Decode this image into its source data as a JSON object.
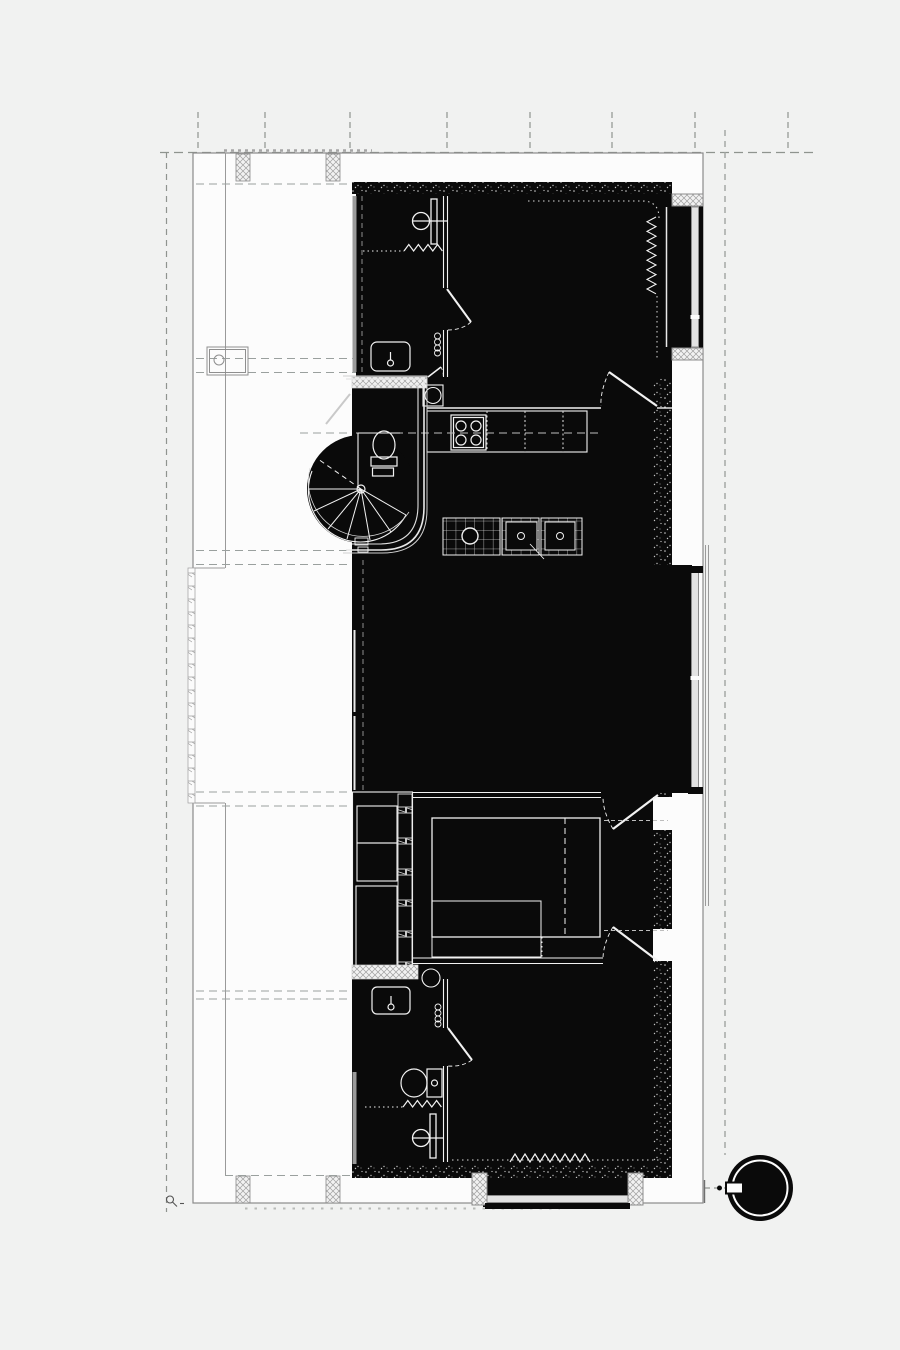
{
  "meta": {
    "title": "architectural floor plan",
    "drawing_type": "apartment plan, presentation style (solid black poché)",
    "canvas": {
      "width": 900,
      "height": 1350
    }
  },
  "colors": {
    "background": "#f1f2f1",
    "paper_white": "#fcfcfc",
    "plan_black": "#0a0a0a",
    "line_gray": "#9a9a9a",
    "dash_gray": "#a7aba8",
    "glazing_fill": "#e3e3e3",
    "glazing_line": "#8c8c8c",
    "fixture_line": "#f2f2f2"
  },
  "features": [
    "site-grid-lines",
    "building-outline",
    "column-piers",
    "top-bathroom: shower-icon, radiator-icon, washbasin-icon, door-swing",
    "top-bedroom: curtain-dotted-corner, radiator-icon, window-glazing, door-swing",
    "kitchen: stove-icon, counter, washing-machine-icon, island with sink-icons",
    "wc: toilet-icon, spiral-staircase-icon, curved-wall",
    "living-room: window-glazing, balcony-railing",
    "middle-bedroom: wardrobe-icon, double-bed-icon, two door-swings",
    "bottom-bathroom: washbasin-icon, washing-machine-icon, toilet-icon, radiator-icon, shower-icon",
    "bottom-bedroom: radiator-icon, bay-window-glazing",
    "tree-icon",
    "benchmark-icon"
  ]
}
